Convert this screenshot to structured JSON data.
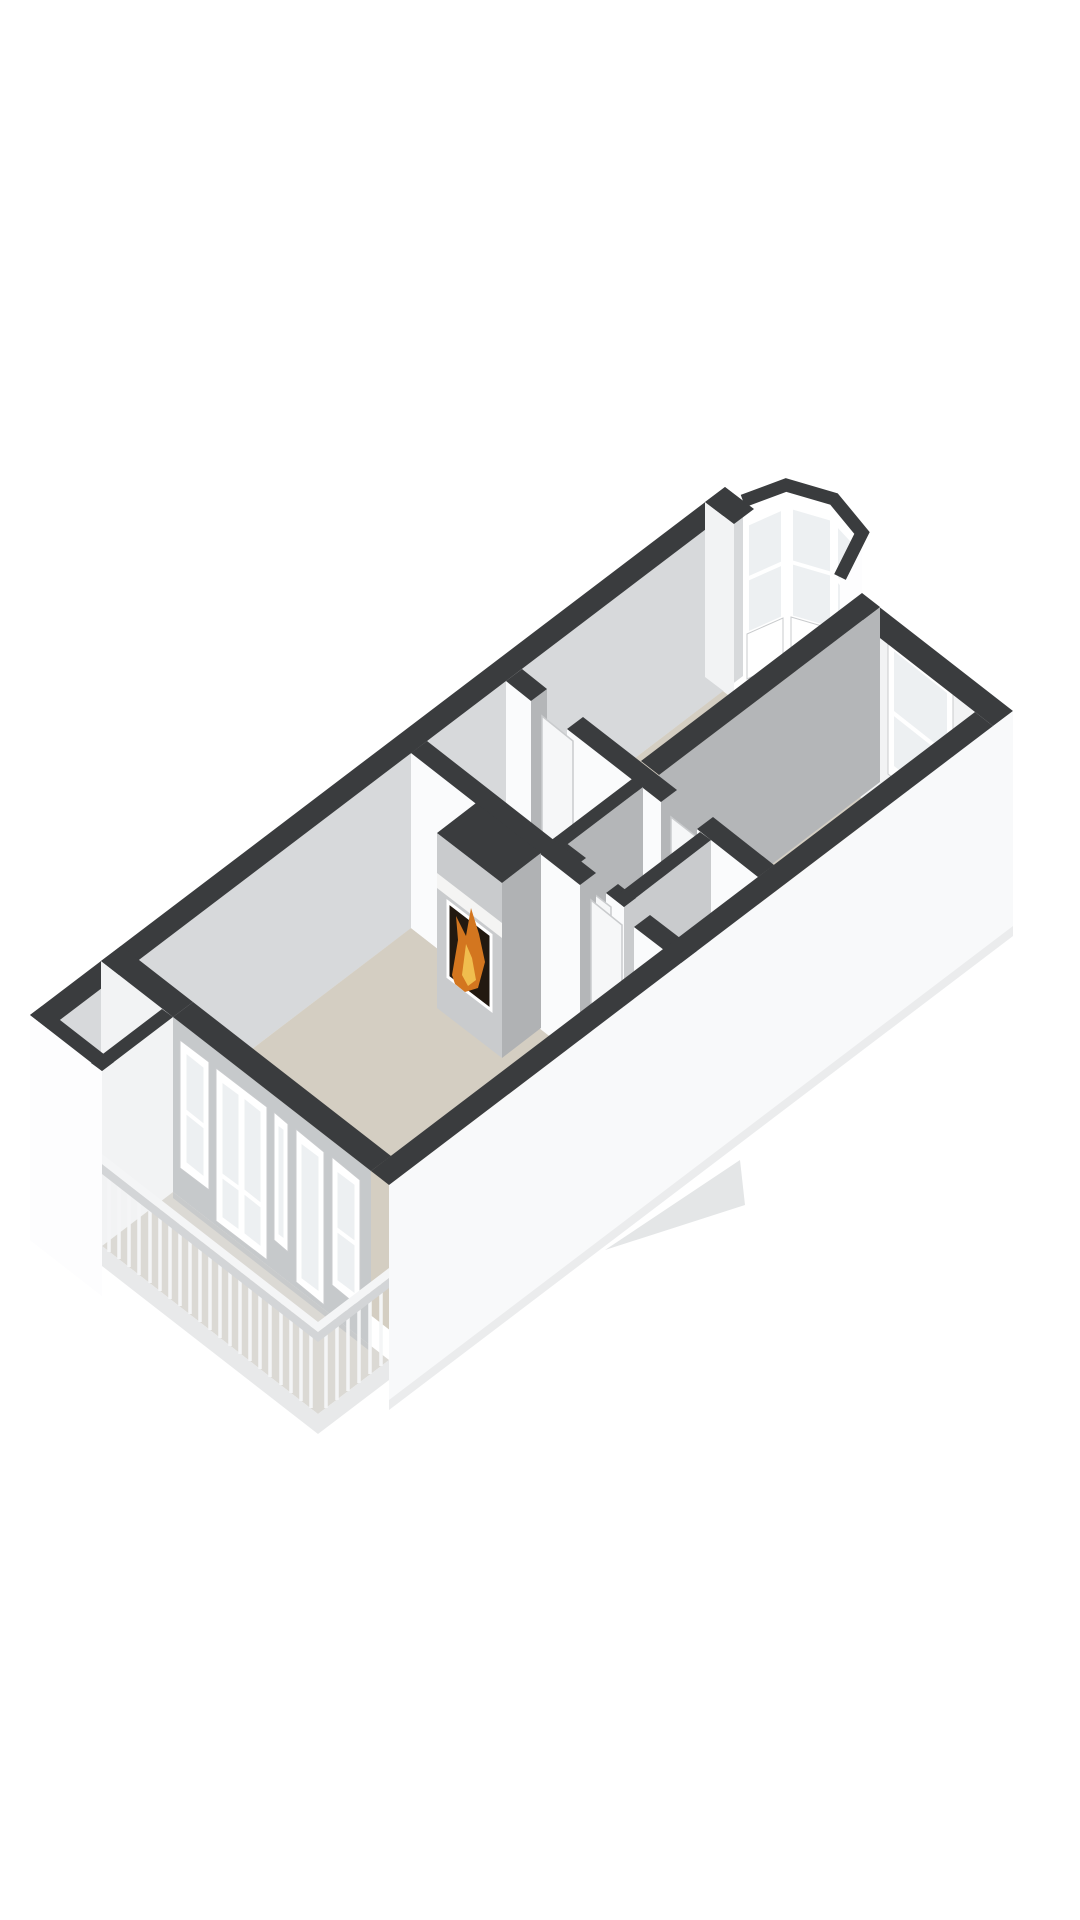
{
  "image": {
    "kind": "3d-floor-plan-render",
    "background": "#ffffff",
    "view": "isometric-birdseye",
    "visible_text": ""
  },
  "colors": {
    "bg": "#ffffff",
    "cap": "#3a3c3e",
    "nw_inner": "#d7d9db",
    "ne_inner": "#f2f3f4",
    "face_sw": "#fafbfc",
    "face_se": "#b4b6b8",
    "outer_white": "#fdfdfe",
    "se_slab": "#f8f9fa",
    "facade": "#c6c9cb",
    "floor_room": "#d4cec2",
    "floor_hall": "#d8d4cb",
    "floor_deck": "#dbd9d4",
    "floor_corner": "#e4e5e6",
    "glass": "#edf0f2",
    "frame": "#ffffff",
    "door": "#f6f7f8",
    "door_edge": "#c9cbcd",
    "rail": "#f4f5f6",
    "rail_shadow": "#d3d5d7",
    "fascia": "#e8e9ea",
    "fire_bg": "#221910",
    "fire_orange": "#d3761f",
    "fire_yellow": "#f0bd4e",
    "mantel": "#f4f4f3",
    "fixture": "#ffffff",
    "wedge": "#e4e6e7",
    "deck_shadow": "#c8cacb",
    "foundation": "#ebeced",
    "chimney_sw": "#c9cbcd",
    "chimney_se": "#b0b2b4"
  },
  "scene": {
    "elements": [
      "exterior-walls-dark-caps",
      "living-room",
      "hallway",
      "bay-window-bedroom",
      "right-bedroom",
      "toilet-room",
      "balcony-deck",
      "balcony-storage-room",
      "fireplace-with-fire",
      "balcony-railing",
      "facade-french-doors"
    ],
    "railing": {
      "post_count_front": 22,
      "post_count_side": 6
    },
    "facade_units": [
      "window",
      "french-door-pair",
      "narrow-window",
      "glazed-door",
      "window"
    ],
    "bay_window_panels": 3,
    "toilet_fixtures": 2,
    "interior_doors": 4
  }
}
